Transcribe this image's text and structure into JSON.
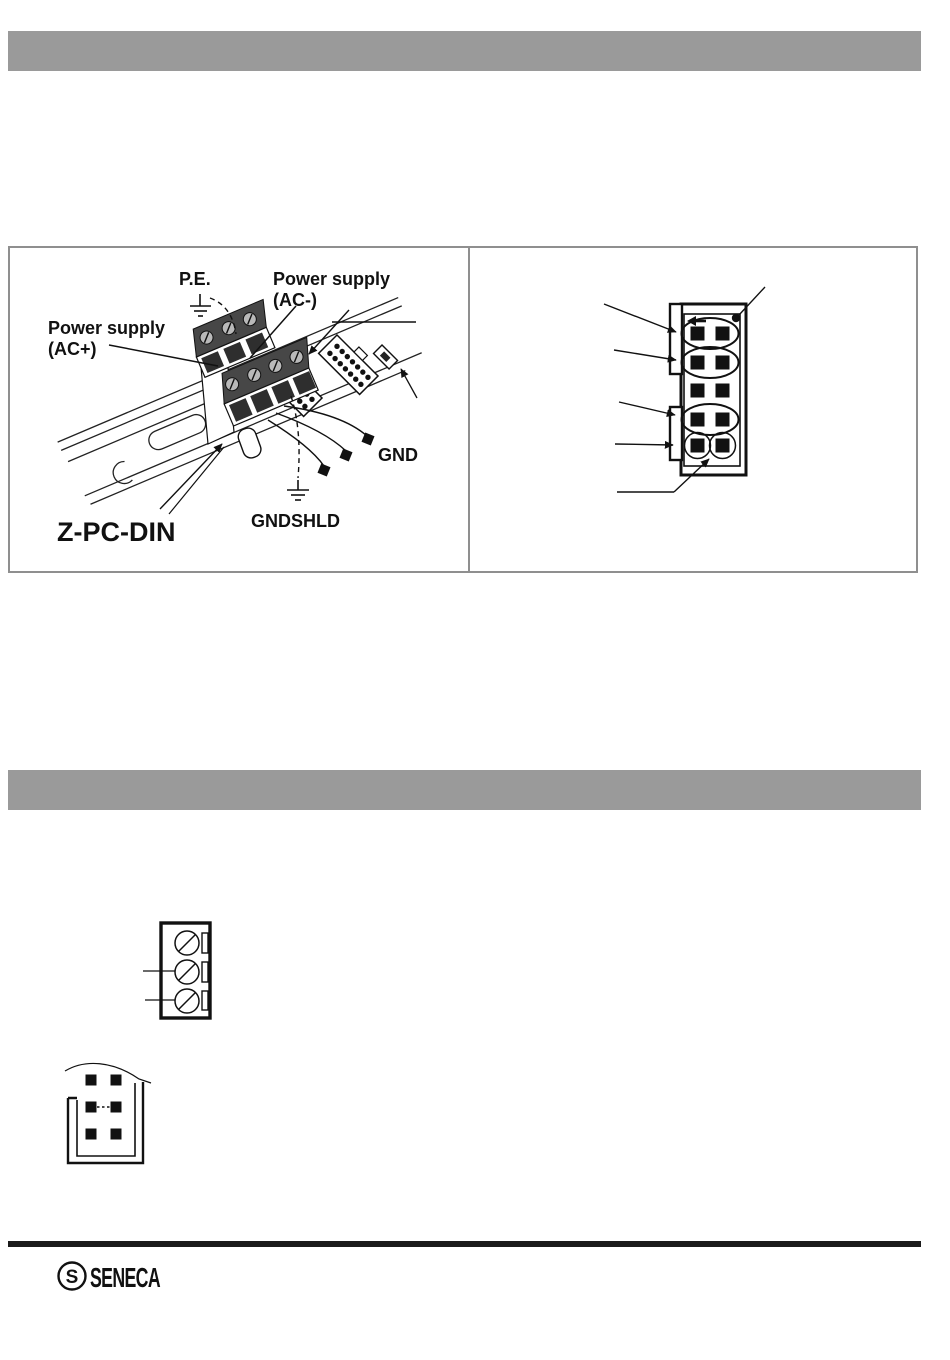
{
  "page": {
    "width": 950,
    "height": 1360,
    "background": "#ffffff"
  },
  "bars": {
    "top_color": "#9a9a9a",
    "section_color": "#9a9a9a",
    "footer_rule_color": "#1b1b1b"
  },
  "wiring_diagram": {
    "labels": {
      "pe": "P.E.",
      "power_supply_minus_line1": "Power supply",
      "power_supply_minus_line2": "(AC-)",
      "power_supply_plus_line1": "Power supply",
      "power_supply_plus_line2": "(AC+)",
      "gnd": "GND",
      "gndshld": "GNDSHLD",
      "din_rail": "Z-PC-DIN"
    },
    "parts": {
      "screw_terminal_blocks": 2,
      "bus_connectors_14pin": 2,
      "jumper": 1,
      "wire_end_markers": 3,
      "earth_symbols": 2
    }
  },
  "pinout_diagram": {
    "pin_columns": 2,
    "pin_rows": 5,
    "oval_grouped_rows": [
      1,
      2,
      4
    ],
    "individually_circled_row": 5,
    "orientation_mark": "left-arrow",
    "corner_mark": "dot",
    "leader_arrows": 5
  },
  "terminal_block_diagram": {
    "screw_count": 3,
    "leader_lines": 2
  },
  "jumper_connector_diagram": {
    "pin_rows": 3,
    "pin_columns": 2,
    "has_cable_arc": true
  },
  "footer": {
    "logo_text": "SENECA",
    "logo_mark": "S"
  }
}
